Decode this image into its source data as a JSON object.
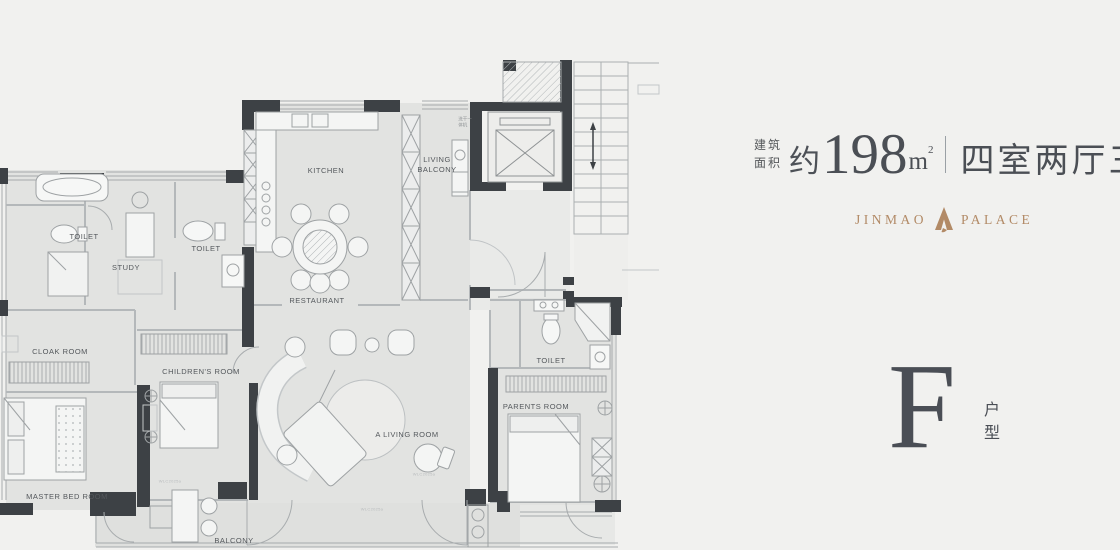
{
  "plan": {
    "rooms": {
      "toilet_left": "TOILET",
      "study": "STUDY",
      "toilet_mid": "TOILET",
      "kitchen": "KITCHEN",
      "living_balcony_line1": "LIVING",
      "living_balcony_line2": "BALCONY",
      "restaurant": "RESTAURANT",
      "cloak": "CLOAK ROOM",
      "children": "CHILDREN'S ROOM",
      "master": "MASTER BED ROOM",
      "living": "A LIVING ROOM",
      "toilet_right": "TOILET",
      "parents": "PARENTS ROOM",
      "balcony": "BALCONY"
    },
    "annotations": {
      "washer_line1": "洗干一",
      "washer_line2": "体机",
      "dim_mark": "WLC2025a"
    }
  },
  "header": {
    "area_prefix_line1": "建筑",
    "area_prefix_line2": "面积",
    "area_approx": "约",
    "area_number": "198",
    "area_unit": "m",
    "area_unit_sup": "2",
    "layout_type": "四室两厅三卫"
  },
  "brand": {
    "name_left": "JINMAO",
    "name_right": "PALACE"
  },
  "unit": {
    "letter": "F",
    "type_char1": "户",
    "type_char2": "型"
  },
  "colors": {
    "accent_gold": "#b28a66",
    "ink": "#4b4f55",
    "wall": "#3d4145",
    "room_fill": "#e2e3e1",
    "background": "#f1f1ef"
  }
}
